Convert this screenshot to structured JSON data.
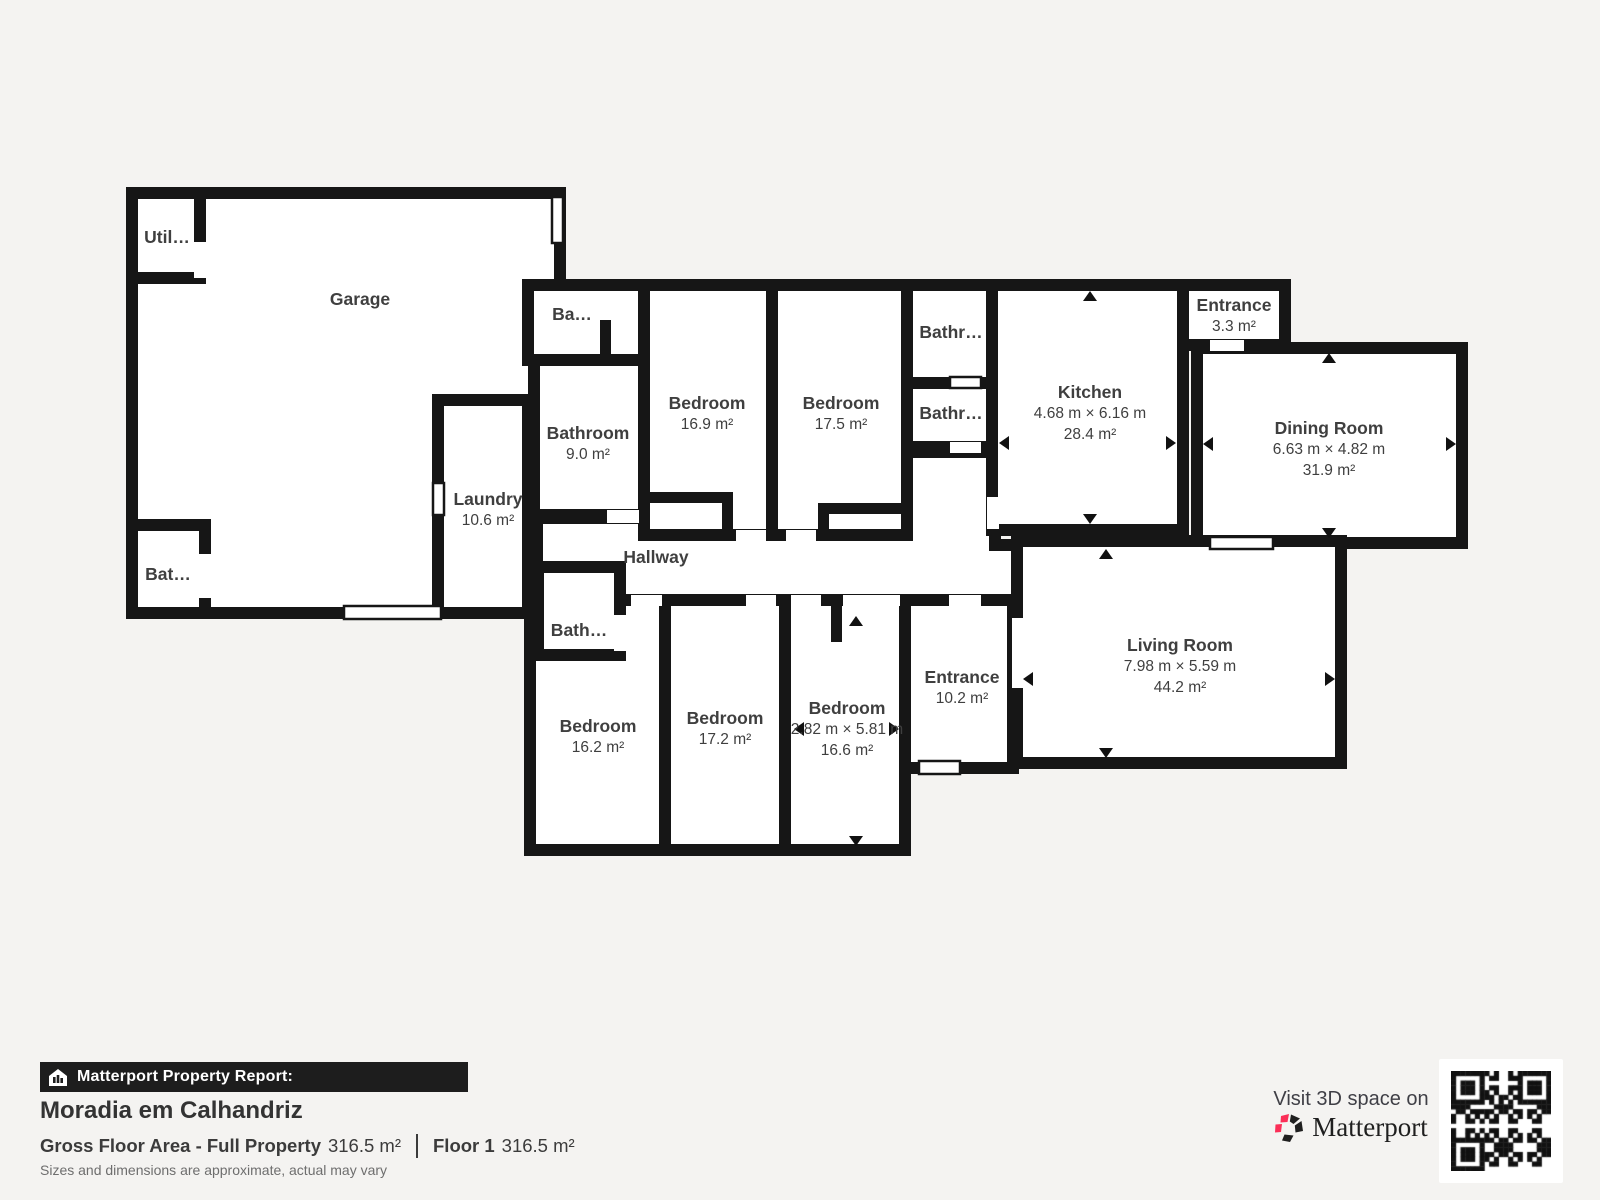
{
  "page": {
    "background": "#f4f3f1",
    "wall_color": "#161616",
    "accent_pink": "#fb2e57"
  },
  "rooms": [
    {
      "name": "Garage"
    },
    {
      "name": "Util…"
    },
    {
      "name": "Bat…"
    },
    {
      "name": "Ba…"
    },
    {
      "name": "Bathroom",
      "area": "9.0 m²"
    },
    {
      "name": "Laundry",
      "area": "10.6 m²"
    },
    {
      "name": "Bedroom",
      "area": "16.9 m²"
    },
    {
      "name": "Bedroom",
      "area": "17.5 m²"
    },
    {
      "name": "Bathr…"
    },
    {
      "name": "Bathr…"
    },
    {
      "name": "Kitchen",
      "dims": "4.68 m × 6.16 m",
      "area": "28.4 m²"
    },
    {
      "name": "Entrance",
      "area": "3.3 m²"
    },
    {
      "name": "Dining Room",
      "dims": "6.63 m × 4.82 m",
      "area": "31.9 m²"
    },
    {
      "name": "Hallway"
    },
    {
      "name": "Bath…"
    },
    {
      "name": "Bedroom",
      "area": "16.2 m²"
    },
    {
      "name": "Bedroom",
      "area": "17.2 m²"
    },
    {
      "name": "Bedroom",
      "dims": "2.82 m × 5.81 m",
      "area": "16.6 m²"
    },
    {
      "name": "Entrance",
      "area": "10.2 m²"
    },
    {
      "name": "Living Room",
      "dims": "7.98 m × 5.59 m",
      "area": "44.2 m²"
    }
  ],
  "report": {
    "bar_label": "Matterport Property Report:",
    "title": "Moradia em Calhandriz",
    "gross_label": "Gross Floor Area - Full Property",
    "gross_value": "316.5 m²",
    "floor_label": "Floor 1",
    "floor_value": "316.5 m²",
    "note": "Sizes and dimensions are approximate, actual may vary"
  },
  "footer3d": {
    "visit_label": "Visit 3D space on",
    "brand": "Matterport"
  }
}
